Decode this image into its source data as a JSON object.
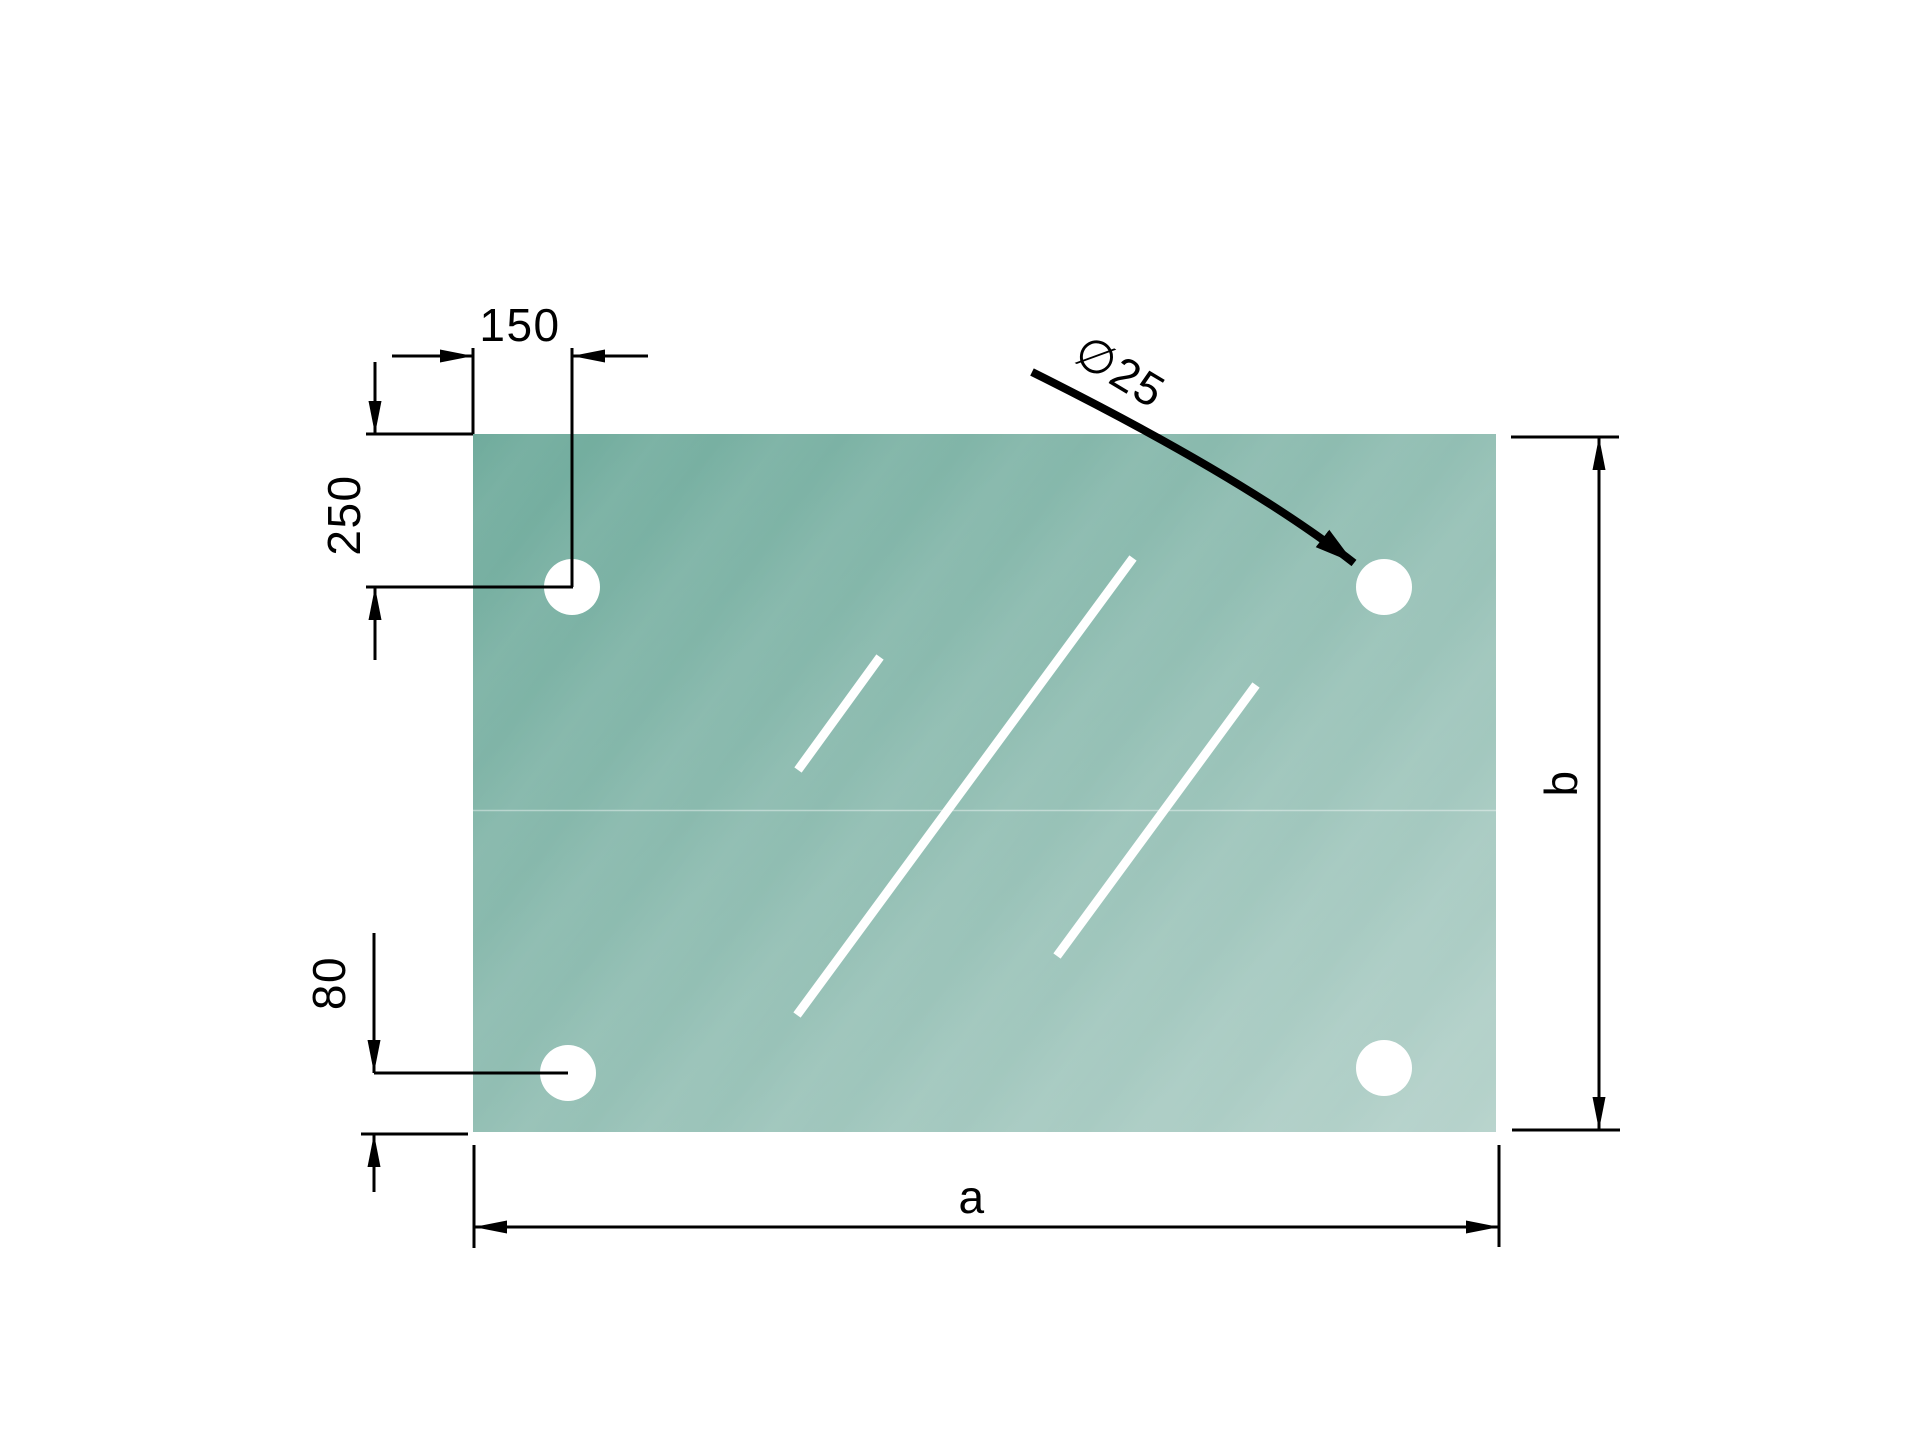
{
  "document": {
    "type": "technical-drawing",
    "subject": "rectangular glass panel with four mounting holes"
  },
  "colors": {
    "background": "#ffffff",
    "line": "#000000",
    "glass_top_left": "#6FAB9C",
    "glass_bottom_right": "#B7D3CC",
    "shine": "#ffffff"
  },
  "dimensions": {
    "hole_offset_x": {
      "label": "150",
      "meaning": "horizontal distance from left edge to hole center"
    },
    "hole_offset_y": {
      "label": "250",
      "meaning": "vertical distance from top edge to hole center"
    },
    "hole_offset_bottom": {
      "label": "80",
      "meaning": "vertical distance from hole center to bottom edge"
    },
    "hole_diameter": {
      "label": "∅25",
      "meaning": "hole diameter"
    },
    "panel_width": {
      "label": "a",
      "meaning": "overall panel width"
    },
    "panel_height": {
      "label": "b",
      "meaning": "overall panel height"
    }
  }
}
